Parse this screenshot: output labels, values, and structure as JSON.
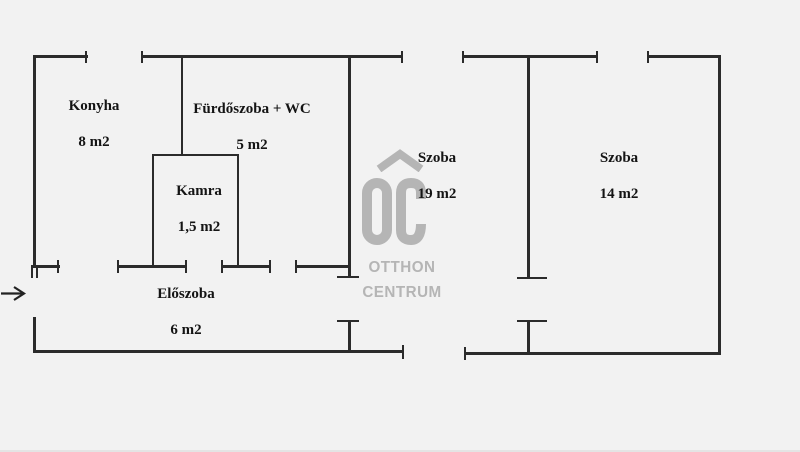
{
  "canvas": {
    "background": "#f2f2f2",
    "wall_color": "#2b2b2b",
    "label_color": "#141414"
  },
  "rooms": [
    {
      "id": "konyha",
      "name": "Konyha",
      "area": "8 m2"
    },
    {
      "id": "furdoszoba",
      "name": "Fürdőszoba + WC",
      "area": "5 m2"
    },
    {
      "id": "kamra",
      "name": "Kamra",
      "area": "1,5 m2"
    },
    {
      "id": "eloszoba",
      "name": "Előszoba",
      "area": "6 m2"
    },
    {
      "id": "szoba-1",
      "name": "Szoba",
      "area": "19 m2"
    },
    {
      "id": "szoba-2",
      "name": "Szoba",
      "area": "14 m2"
    }
  ],
  "watermark": {
    "monogram": "OC",
    "line1": "OTTHON",
    "line2": "CENTRUM",
    "color": "#b5b5b5"
  }
}
